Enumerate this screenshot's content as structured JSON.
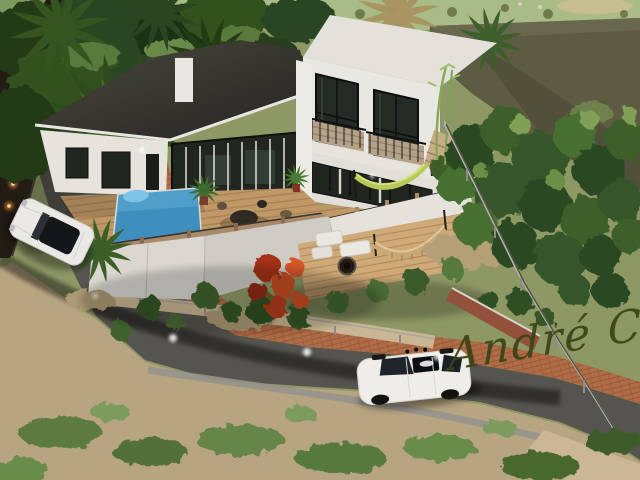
{
  "watermark": {
    "text": "André C",
    "color": "#3b4517"
  },
  "palette": {
    "field": "#a9bb87",
    "slope": "#5d5c43",
    "garden": "#8e9865",
    "sand": "#b7a481",
    "road": "#56544e",
    "brick": "#b06c46",
    "wall_top": "#c8b694",
    "house_wall": "#e9e7e1",
    "roof_flat": "#e3e1da",
    "roof_dark": "#35332c",
    "glass": "#20261f",
    "deck_wood": "#bf9866",
    "pool": "#3e8fbe",
    "foliage_dark": "#2b4520",
    "foliage_light": "#6c8f47",
    "wall_light": "#ff8c2e",
    "signature": "#3b4517",
    "car_body": "#efede9"
  }
}
